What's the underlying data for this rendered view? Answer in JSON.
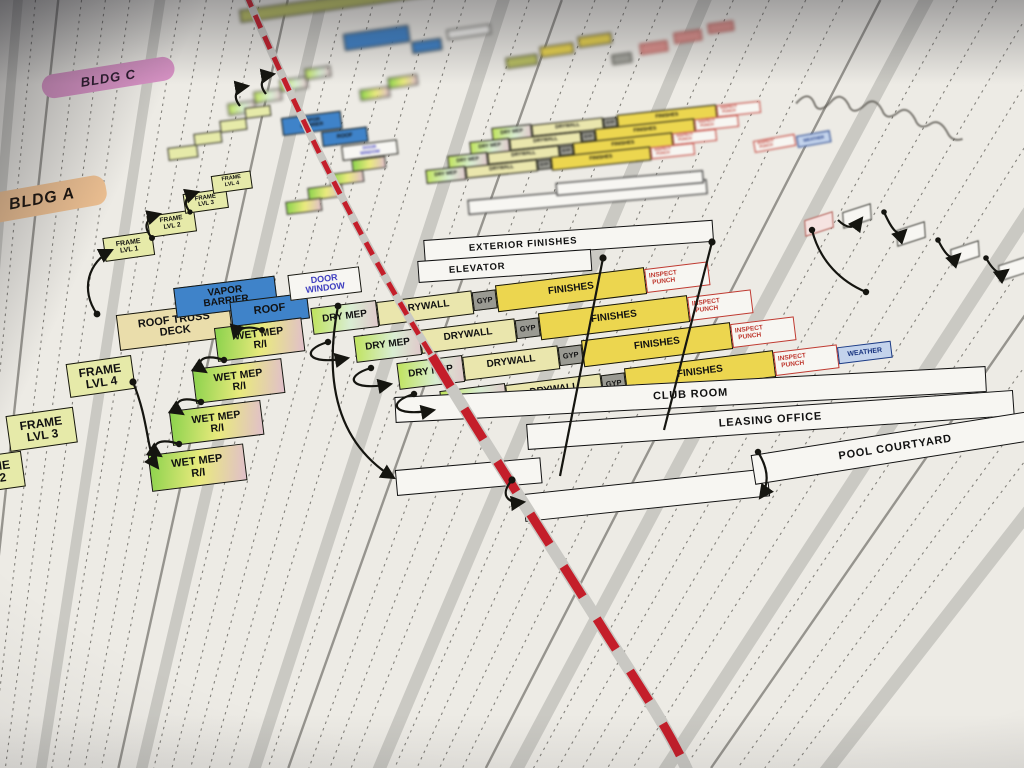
{
  "tags": {
    "bldg_c": "BLDG C",
    "bldg_a": "BLDG A"
  },
  "bars": {
    "exterior_finishes": "EXTERIOR FINISHES",
    "elevator": "ELEVATOR",
    "club_room": "CLUB ROOM",
    "leasing_office": "LEASING OFFICE",
    "pool_courtyard": "POOL COURTYARD"
  },
  "tasks": {
    "frame_lvl_1_l1": "FRAME",
    "frame_lvl_1_l2": "LVL 1",
    "frame_lvl_2_l1": "FRAME",
    "frame_lvl_2_l2": "LVL 2",
    "frame_lvl_3_l1": "FRAME",
    "frame_lvl_3_l2": "LVL 3",
    "frame_lvl_4_l1": "FRAME",
    "frame_lvl_4_l2": "LVL 4",
    "wet_mep_l1": "WET MEP",
    "wet_mep_l2": "R/I",
    "dry_mep": "DRY MEP",
    "drywall": "DRYWALL",
    "gyp": "GYP",
    "finishes": "FINISHES",
    "inspect_punch_l1": "INSPECT",
    "inspect_punch_l2": "PUNCH",
    "weather": "WEATHER",
    "vapor_barrier_l1": "VAPOR",
    "vapor_barrier_l2": "BARRIER",
    "roof": "ROOF",
    "roof_truss_l1": "ROOF TRUSS",
    "roof_truss_l2": "DECK",
    "door_window_l1": "DOOR",
    "door_window_l2": "WINDOW"
  },
  "colors": {
    "paper": "#edebe5",
    "tag_bldg_c": "#d893c5",
    "tag_bldg_a": "#edc092",
    "frame_fill": "#e6eaa9",
    "drywall_fill": "#eae6ad",
    "gyp_fill": "#9a9a92",
    "finishes_fill": "#ecd64f",
    "blue_fill": "#3f83c9",
    "deck_fill": "#eaddab",
    "door_window_text": "#4040c0",
    "punch_red": "#bf3a31",
    "weather_bg": "#c3d3ec",
    "weather_text": "#17337f",
    "today_line": "#c41e2a",
    "bar_bg": "#f7f6f2",
    "wet_grad_a": "#8bd24c",
    "wet_grad_b": "#e9ea7d",
    "wet_grad_c": "#e0bfca",
    "dry_grad_a": "#bfe35c",
    "dry_grad_b": "#d9edd2",
    "dry_grad_c": "#e0c9cb"
  }
}
